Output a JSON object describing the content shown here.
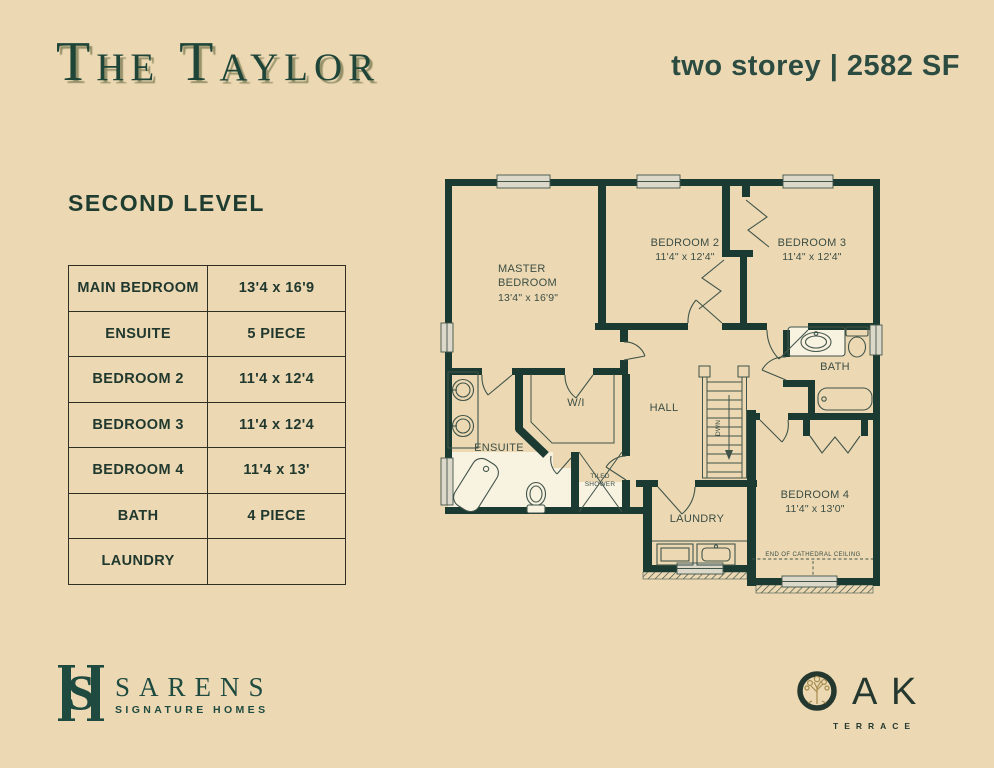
{
  "header": {
    "title": "The Taylor",
    "subtitle": "two storey | 2582 SF"
  },
  "level_label": "SECOND LEVEL",
  "table": {
    "rows": [
      {
        "label": "MAIN BEDROOM",
        "value": "13'4 x 16'9"
      },
      {
        "label": "ENSUITE",
        "value": "5 PIECE"
      },
      {
        "label": "BEDROOM 2",
        "value": "11'4 x 12'4"
      },
      {
        "label": "BEDROOM 3",
        "value": "11'4 x 12'4"
      },
      {
        "label": "BEDROOM 4",
        "value": "11'4 x 13'"
      },
      {
        "label": "BATH",
        "value": "4 PIECE"
      },
      {
        "label": "LAUNDRY",
        "value": ""
      }
    ]
  },
  "plan": {
    "master_l1": "MASTER",
    "master_l2": "BEDROOM",
    "master_dims": "13'4\" x 16'9\"",
    "bedroom2": "BEDROOM 2",
    "bedroom2_dims": "11'4\" x 12'4\"",
    "bedroom3": "BEDROOM 3",
    "bedroom3_dims": "11'4\" x 12'4\"",
    "bedroom4": "BEDROOM 4",
    "bedroom4_dims": "11'4\" x 13'0\"",
    "ensuite": "ENSUITE",
    "wi": "W/I",
    "hall": "HALL",
    "bath": "BATH",
    "shower_l1": "TILED",
    "shower_l2": "SHOWER",
    "laundry": "LAUNDRY",
    "stairs_dir": "DWN",
    "cathedral": "END OF CATHEDRAL CEILING"
  },
  "logos": {
    "sarens": {
      "monogram_s": "S",
      "name": "SARENS",
      "tagline": "SIGNATURE HOMES"
    },
    "oak": {
      "letter_a": "A",
      "letter_k": "K",
      "tagline": "TERRACE"
    }
  },
  "colors": {
    "background": "#ecd9b3",
    "wall": "#1b3a31",
    "title_green": "#1f4539",
    "accent_green": "#2c4c42",
    "thin_line": "#41544a",
    "white_floor": "#f8f2e1",
    "window_fill": "#dcd9ca",
    "logo_gold": "#a68c4e"
  }
}
